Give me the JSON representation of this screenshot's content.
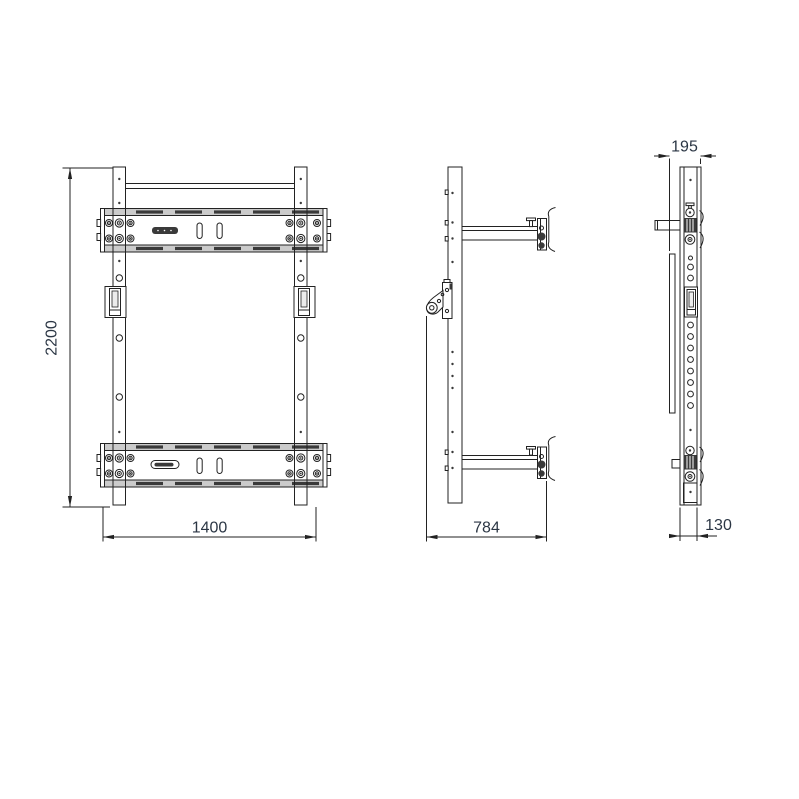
{
  "drawing": {
    "dimensions": {
      "front_height": "2200",
      "front_width": "1400",
      "side_depth": "784",
      "profile_top_depth": "195",
      "profile_bottom_depth": "130"
    },
    "colors": {
      "background": "#ffffff",
      "line": "#222222",
      "dimension_text": "#2b3644",
      "flange_fill": "#cbcbcb",
      "slot_fill": "#3a3a3a"
    }
  }
}
